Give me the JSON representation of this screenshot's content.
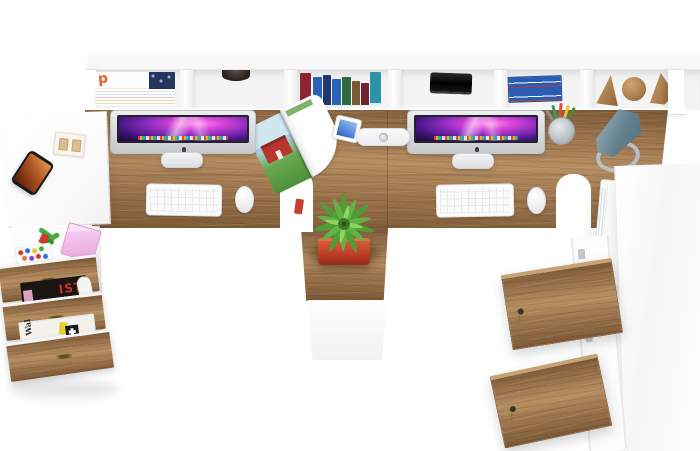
{
  "scene": {
    "title": "Top-down 3D render of a white and wood double computer workstation",
    "labels": {
      "magazine_p": "p",
      "magazine_ist": "IST",
      "newspaper_wal": "Wal"
    },
    "palette": {
      "wood_base": "#9b744e",
      "wood_dark": "#7c5936",
      "wood_light": "#b68e61",
      "screen_magenta": "#d844d8",
      "screen_violet": "#43157f",
      "screen_glow": "#ff8ae8",
      "plant_green": "#4e9e35",
      "plant_green_light": "#8fd45f",
      "pot_red": "#bb3d27",
      "lamp_teal": "#64808d",
      "lamp_ring": "#b6c0c6",
      "barn_red": "#b8352a",
      "magazine_orange": "#e8622d",
      "label_red": "#cf2f24",
      "book_colors": [
        "#8c2433",
        "#2a62b8",
        "#20386f",
        "#2a62b8",
        "#2d6b3f",
        "#7a5a35",
        "#6e222c",
        "#2e93a8"
      ]
    },
    "objects": [
      "wall-shelf-with-compartments",
      "magazine-stack",
      "dark-bowl",
      "book-row",
      "black-speaker",
      "blue-book-stack",
      "wooden-bookends",
      "left-side-table",
      "smartphone",
      "cassette-holder",
      "left-desk",
      "right-desk",
      "imac-left",
      "imac-right",
      "keyboard-left",
      "keyboard-right",
      "mouse-left",
      "mouse-right",
      "open-magazine-barn-photo",
      "tablet",
      "power-strip",
      "pencil-cup",
      "desk-lamp",
      "paper-tray",
      "potted-plant-red-pot",
      "center-pedestal-cabinet",
      "left-drawer-unit-open",
      "toys-drawer",
      "magazines-drawer",
      "newspaper-drawer",
      "right-cabinet-open-wood-doors"
    ]
  }
}
